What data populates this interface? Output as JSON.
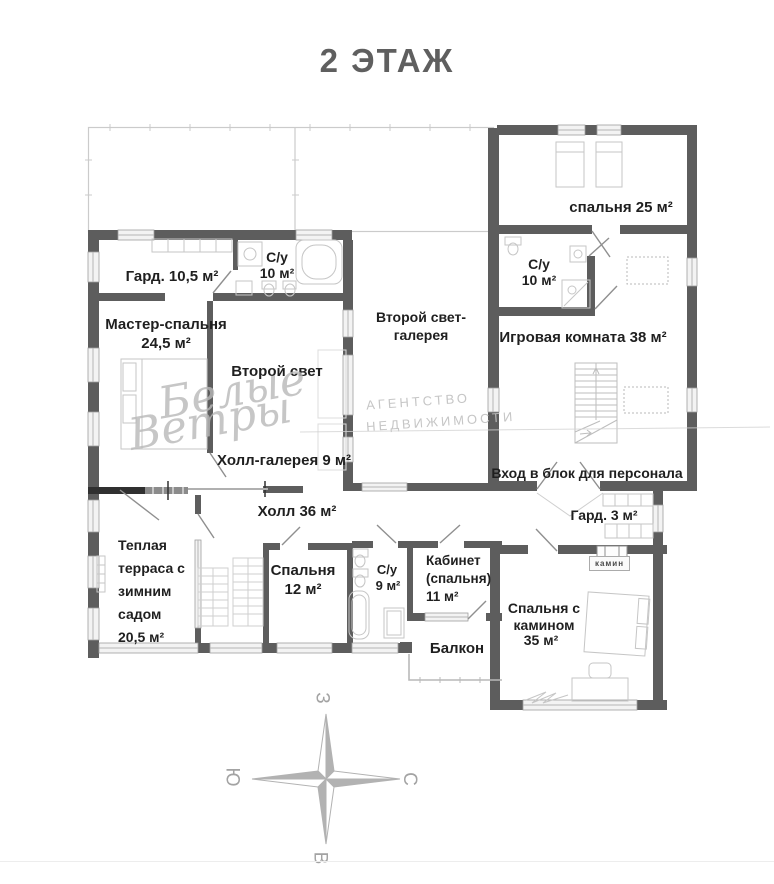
{
  "title": "2 ЭТАЖ",
  "colors": {
    "wall": "#5d5d5d",
    "dark_partition": "#303030",
    "text": "#1f1f1f",
    "light_lines": "#c6c6c6",
    "title_text": "#5f5f5f",
    "watermark": "#b8b8b8"
  },
  "compass": {
    "west": "З",
    "south": "Ю",
    "north": "С",
    "east": "В"
  },
  "watermark": {
    "script_line1": "Белые",
    "script_line2": "Ветры",
    "caption_line1": "АГЕНТСТВО",
    "caption_line2": "НЕДВИЖИМОСТИ"
  },
  "rooms": {
    "wardrobe_105": {
      "label": "Гард. 10,5 м²"
    },
    "bathroom_10_left": {
      "name": "С/у",
      "area": "10 м²"
    },
    "master_bedroom": {
      "name": "Мастер-спальня",
      "area": "24,5 м²"
    },
    "second_light": {
      "label": "Второй свет"
    },
    "second_light_gallery": {
      "line1": "Второй свет-",
      "line2": "галерея"
    },
    "hall_gallery": {
      "label": "Холл-галерея 9 м²"
    },
    "bedroom_25": {
      "label": "спальня 25 м²"
    },
    "bathroom_10_right": {
      "name": "С/у",
      "area": "10 м²"
    },
    "playroom": {
      "label": "Игровая комната 38 м²"
    },
    "staff_entrance": {
      "label": "Вход в блок для персонала"
    },
    "wardrobe_3": {
      "label": "Гард. 3 м²"
    },
    "hall_36": {
      "label": "Холл 36 м²"
    },
    "terrace": {
      "line1": "Теплая",
      "line2": "терраса с",
      "line3": "зимним",
      "line4": "садом",
      "line5": "20,5 м²"
    },
    "bedroom_12": {
      "name": "Спальня",
      "area": "12 м²"
    },
    "bathroom_9": {
      "name": "С/у",
      "area": "9 м²"
    },
    "cabinet": {
      "line1": "Кабинет",
      "line2": "(спальня)",
      "line3": "11 м²"
    },
    "balcony": {
      "label": "Балкон"
    },
    "fireplace": {
      "label": "камин"
    },
    "bedroom_fireplace": {
      "line1": "Спальня с",
      "line2": "камином",
      "line3": "35 м²"
    }
  }
}
